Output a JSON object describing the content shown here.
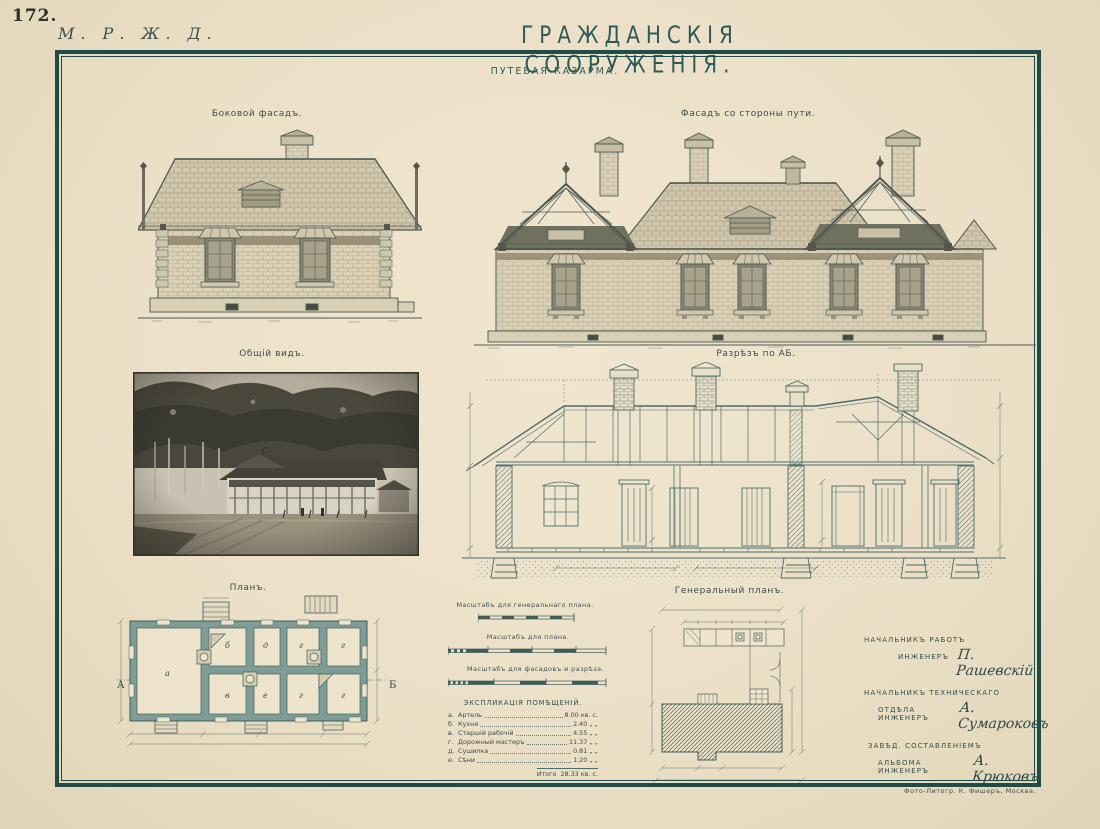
{
  "page": {
    "number": "172.",
    "railway": "М. Р. Ж. Д.",
    "title": "ГРАЖДАНСКІЯ СООРУЖЕНІЯ.",
    "subtitle": "ПУТЕВАЯ КАЗАРМА.",
    "credit": "Фото-Литогр. К. Фишеръ, Москва."
  },
  "figures": {
    "side_facade": {
      "label": "Боковой фасадъ."
    },
    "front_facade": {
      "label": "Фасадъ со стороны пути."
    },
    "general_view": {
      "label": "Общій видъ."
    },
    "section": {
      "label": "Разрѣзъ по АБ."
    },
    "plan": {
      "label": "Планъ.",
      "marker_left": "А",
      "marker_right": "Б",
      "room_letters": [
        "а",
        "б",
        "в",
        "д",
        "е",
        "г",
        "г",
        "г",
        "г"
      ]
    },
    "general_plan": {
      "label": "Генеральный планъ."
    }
  },
  "scales": {
    "general_plan": "Масштабъ для генеральнаго плана.",
    "plan": "Масштабъ для плана.",
    "facades": "Масштабъ для фасадовъ и разрѣза."
  },
  "explication": {
    "title": "ЭКСПЛИКАЦІЯ ПОМѢЩЕНІЙ.",
    "rows": [
      {
        "letter": "а.",
        "name": "Артель",
        "value": "8.00 кв. с."
      },
      {
        "letter": "б.",
        "name": "Кухня",
        "value": "2.40 „ „"
      },
      {
        "letter": "в.",
        "name": "Старшій рабочій",
        "value": "4.55 „ „"
      },
      {
        "letter": "г.",
        "name": "Дорожный мастеръ",
        "value": "11.37 „ „"
      },
      {
        "letter": "д.",
        "name": "Сушилка",
        "value": "0.81 „ „"
      },
      {
        "letter": "е.",
        "name": "Сѣни",
        "value": "1.20 „ „"
      }
    ],
    "total": {
      "label": "Итого",
      "value": "28.33 кв. с."
    }
  },
  "signatures": [
    {
      "dept": "НАЧАЛЬНИКЪ РАБОТЪ",
      "title": "ИНЖЕНЕРЪ",
      "name": "П. Рашевскій"
    },
    {
      "dept": "НАЧАЛЬНИКЪ ТЕХНИЧЕСКАГО",
      "title": "ОТДѢЛА ИНЖЕНЕРЪ",
      "name": "А. Сумароковъ"
    },
    {
      "dept": "ЗАВѢД. СОСТАВЛЕНІЕМЪ",
      "title": "АЛЬБОМА ИНЖЕНЕРЪ",
      "name": "А. Крюковъ"
    }
  ],
  "colors": {
    "paper": "#ece1c8",
    "frame": "#1f4b49",
    "elevation_ink": "#4c5a54",
    "drafting_ink": "#4d6d6b",
    "plan_wall_fill": "#7e9d97"
  }
}
